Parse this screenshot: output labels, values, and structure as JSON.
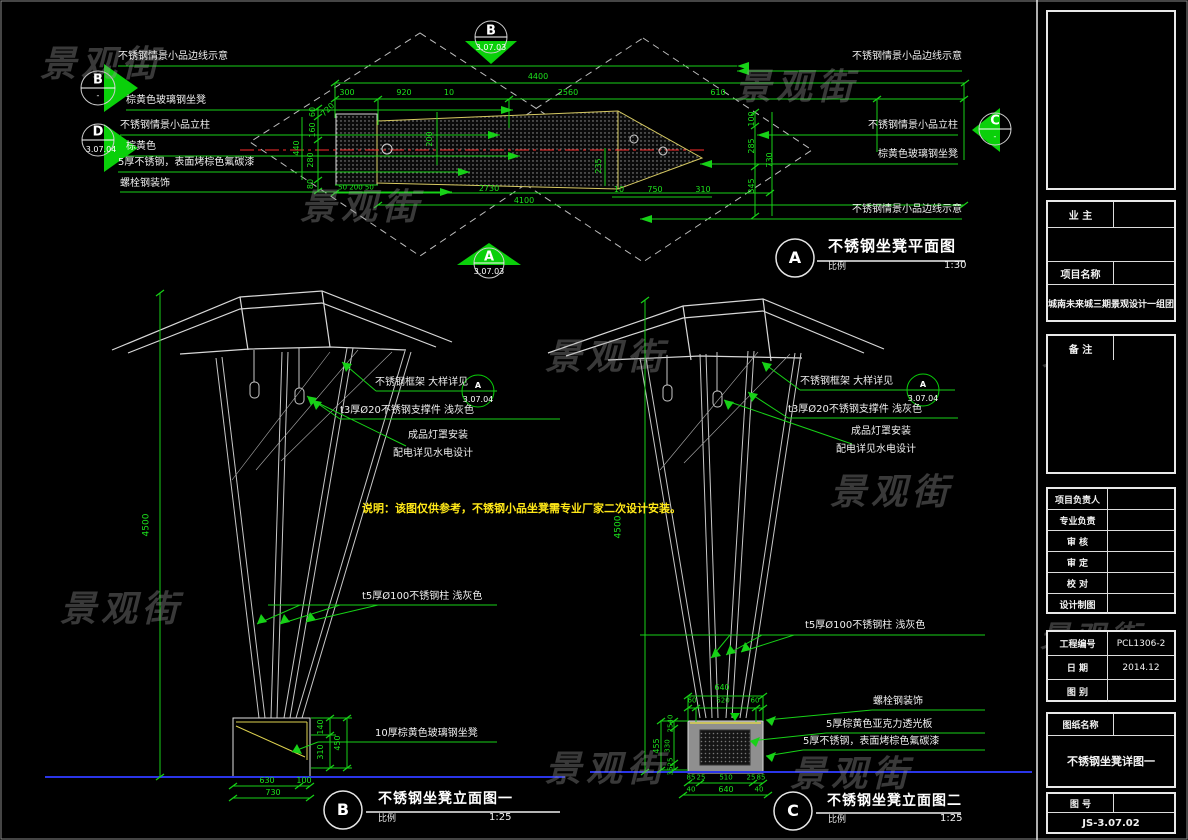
{
  "watermark": {
    "text": "景观街"
  },
  "plan": {
    "title": {
      "letter": "A",
      "name": "不锈钢坐凳平面图",
      "scale_label": "比例",
      "scale": "1:30"
    },
    "labels_left": [
      "不锈钢情景小品边线示意",
      "棕黄色玻璃钢坐凳",
      "不锈钢情景小品立柱",
      "棕黄色",
      "5厚不锈钢，表面烤棕色氟碳漆",
      "螺栓钢装饰"
    ],
    "labels_right": [
      "不锈钢情景小品边线示意",
      "不锈钢情景小品立柱",
      "棕黄色玻璃钢坐凳",
      "不锈钢情景小品边线示意"
    ],
    "markers": {
      "top": {
        "letter": "B",
        "ref": "3.07.03"
      },
      "bottom": {
        "letter": "A",
        "ref": "3.07.03"
      },
      "left_b": {
        "letter": "B",
        "ref": "-"
      },
      "left_d": {
        "letter": "D",
        "ref": "3.07.04"
      },
      "right_c": {
        "letter": "C",
        "ref": "-"
      }
    },
    "dims": {
      "total_top": "4400",
      "top_segs": [
        "300",
        "920",
        "10",
        "2560",
        "610"
      ],
      "left": [
        "60",
        "160",
        "280",
        "80"
      ],
      "left_total": "440",
      "right": [
        "100",
        "285",
        "345"
      ],
      "right_total": "730",
      "box_bottom": "50 200 50",
      "mid_bottom": "2730",
      "bottom_total": "4100",
      "lower_segs": [
        "10",
        "750",
        "310"
      ],
      "mid_v": [
        "200",
        "235"
      ],
      "diag": "720"
    }
  },
  "detail_ref": {
    "letter": "A",
    "ref": "3.07.04"
  },
  "note": "说明：该图仅供参考，不锈钢小品坐凳需专业厂家二次设计安装。",
  "elev_b": {
    "title": {
      "letter": "B",
      "name": "不锈钢坐凳立面图一",
      "scale_label": "比例",
      "scale": "1:25"
    },
    "height": "4500",
    "labels": {
      "frame": "不锈钢框架 大样详见",
      "support": "t3厚Ø20不锈钢支撑件 浅灰色",
      "lamp": "成品灯罩安装",
      "power": "配电详见水电设计",
      "column": "t5厚Ø100不锈钢柱 浅灰色",
      "seat": "10厚棕黄色玻璃钢坐凳"
    },
    "dims": {
      "v": [
        "140",
        "310",
        "450"
      ],
      "bottom": [
        "630",
        "100"
      ],
      "bottom_total": "730"
    }
  },
  "elev_c": {
    "title": {
      "letter": "C",
      "name": "不锈钢坐凳立面图二",
      "scale_label": "比例",
      "scale": "1:25"
    },
    "height": "4500",
    "labels": {
      "frame": "不锈钢框架 大样详见",
      "support": "t3厚Ø20不锈钢支撑件 浅灰色",
      "lamp": "成品灯罩安装",
      "power": "配电详见水电设计",
      "column": "t5厚Ø100不锈钢柱 浅灰色",
      "bolt": "螺栓钢装饰",
      "acrylic": "5厚棕黄色亚克力透光板",
      "steel": "5厚不锈钢，表面烤棕色氟碳漆"
    },
    "dims": {
      "top_total": "640",
      "top_segs": [
        "60",
        "520",
        "60"
      ],
      "left": [
        "40",
        "25",
        "330",
        "25",
        "35"
      ],
      "left_total": "455",
      "bottom1": [
        "85",
        "25",
        "510",
        "25",
        "85"
      ],
      "bottom2": [
        "40",
        "640",
        "40"
      ]
    }
  },
  "titleblock": {
    "owner_label": "业  主",
    "project_label": "项目名称",
    "project_name": "城南未来城三期景观设计一组团",
    "remark_label": "备  注",
    "rows": [
      "项目负责人",
      "专业负责",
      "审  核",
      "审  定",
      "校  对",
      "设计制图"
    ],
    "eng_label": "工程编号",
    "eng_no": "PCL1306-2",
    "date_label": "日  期",
    "date": "2014.12",
    "type_label": "图  别",
    "sheet_label": "图纸名称",
    "sheet_name": "不锈钢坐凳详图一",
    "no_label": "图  号",
    "no": "JS-3.07.02"
  }
}
